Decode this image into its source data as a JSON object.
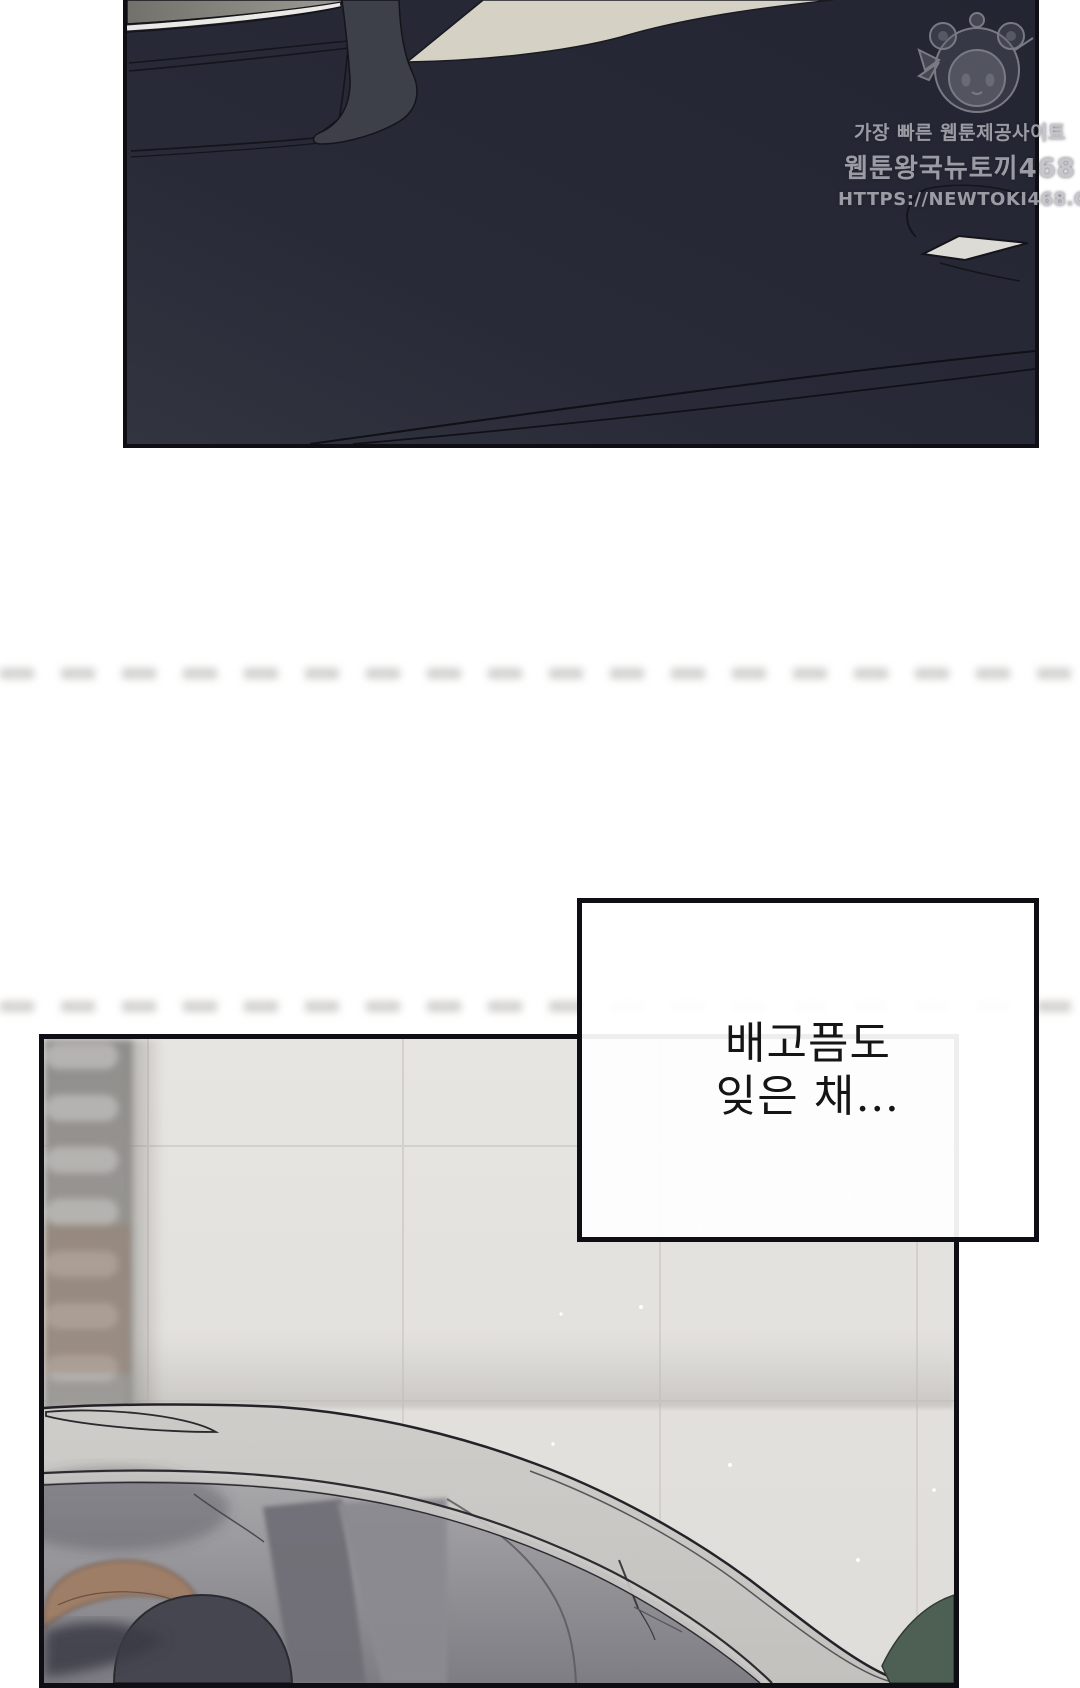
{
  "narration": {
    "line1": "배고픔도",
    "line2": "잊은 채…"
  },
  "watermark": {
    "tagline": "가장 빠른 웹툰제공사이트",
    "site_name": "웹툰왕국뉴토끼468",
    "url": "HTTPS://NEWTOKI468.COM",
    "character": "bear-hood-chibi-mascot"
  },
  "colors": {
    "ink": "#0e0e14",
    "panel_navy": "#262836",
    "panel_navy_light": "#31333f",
    "pillar_gray": "#3e4049",
    "window_glass": "#8d8c86",
    "chrome": "#eae9e5",
    "background_beige": "#d5d2c5",
    "mirror_white": "#dcdbd5",
    "tile_wall": "#e4e2de",
    "tile_seam": "#d2cfca",
    "shutter_base": "#918f8c",
    "shutter_slat": "#b5b3b0",
    "car_roof": "#cfcdc9",
    "roof_strip": "#c9c8c5",
    "windshield_top": "#a9a8aa",
    "windshield_bottom": "#7e7d84",
    "pillar_band": "#8b8a91",
    "pillar_band_dark": "#6f6e76",
    "driver_hair": "#45464f",
    "seat_brown": "#9f7e67",
    "bin_green": "#4d6053",
    "watermark_gray": "#b9b9c0"
  }
}
